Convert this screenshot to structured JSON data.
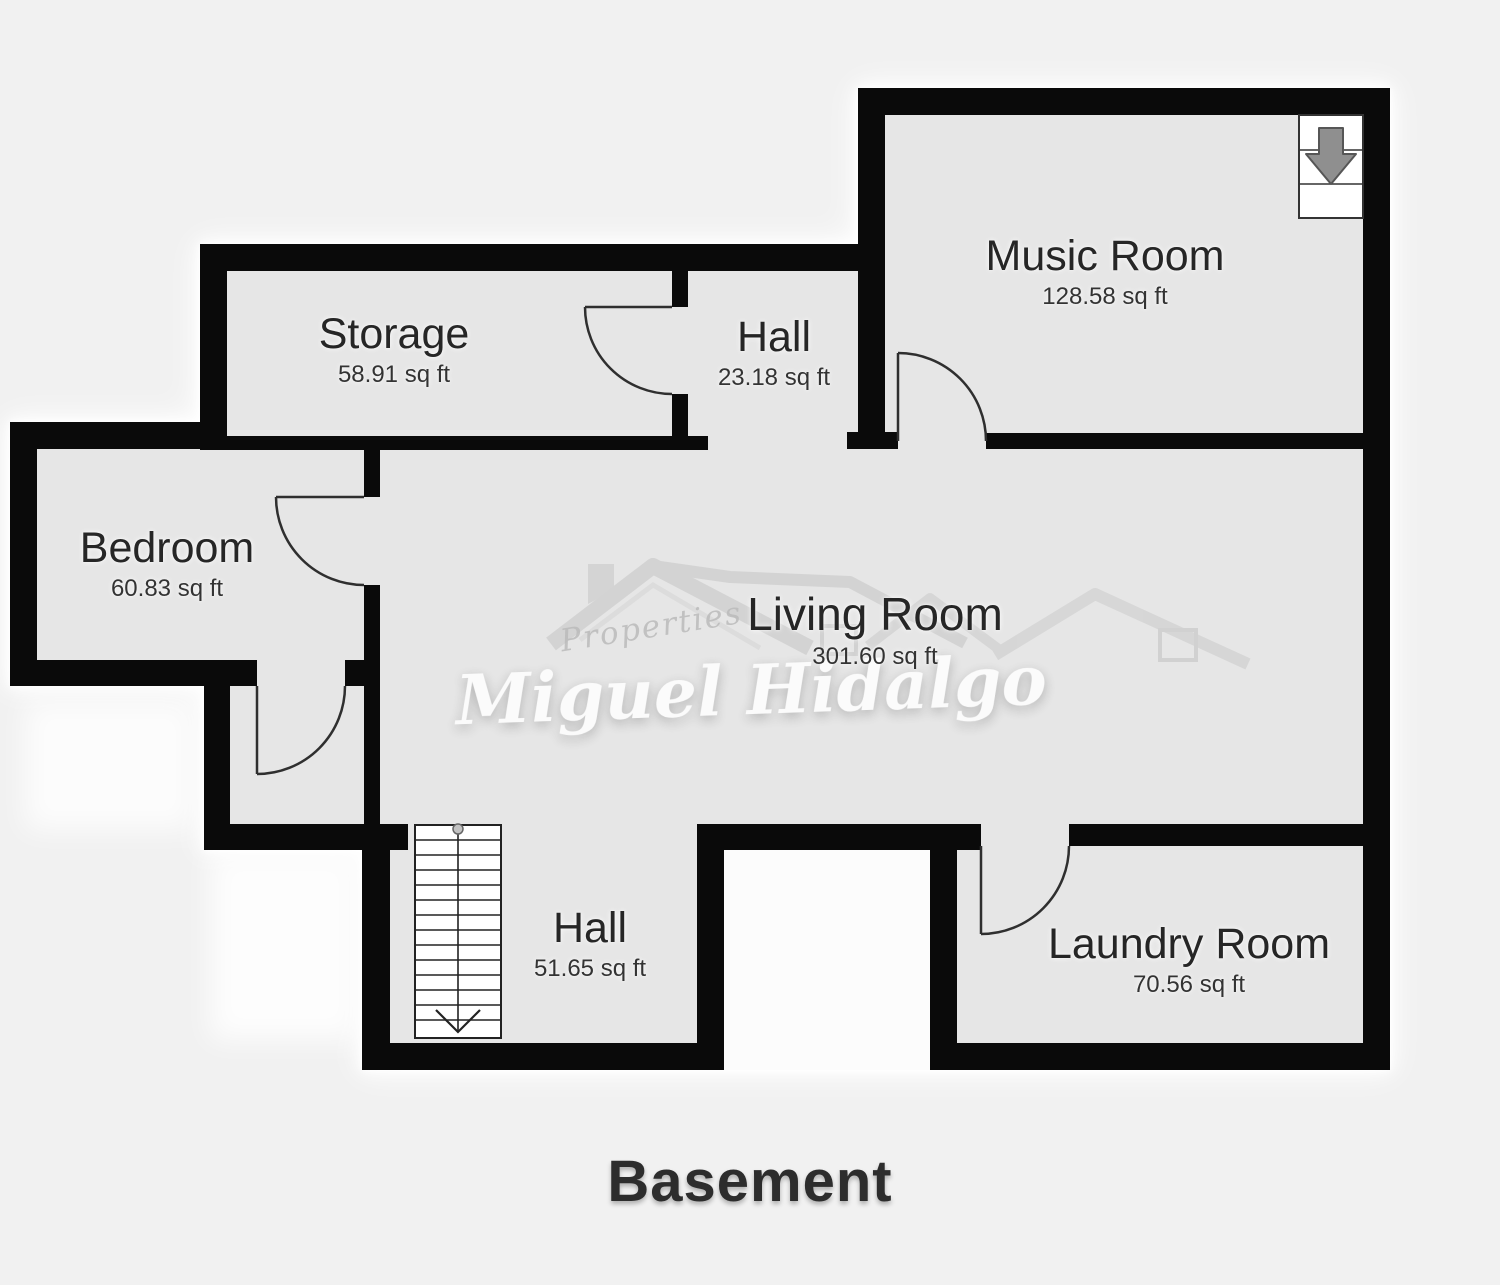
{
  "page": {
    "title": "Basement",
    "background": "#f1f1f1"
  },
  "watermark": {
    "brand_top": "Properties",
    "brand_name": "Miguel Hidalgo"
  },
  "rooms": [
    {
      "id": "music-room",
      "name": "Music Room",
      "area": "128.58 sq ft"
    },
    {
      "id": "storage",
      "name": "Storage",
      "area": "58.91 sq ft"
    },
    {
      "id": "hall-upper",
      "name": "Hall",
      "area": "23.18 sq ft"
    },
    {
      "id": "bedroom",
      "name": "Bedroom",
      "area": "60.83 sq ft"
    },
    {
      "id": "living-room",
      "name": "Living Room",
      "area": "301.60 sq ft"
    },
    {
      "id": "hall-lower",
      "name": "Hall",
      "area": "51.65 sq ft"
    },
    {
      "id": "laundry-room",
      "name": "Laundry Room",
      "area": "70.56 sq ft"
    }
  ],
  "colors": {
    "wall": "#0a0a0a",
    "floor": "#e6e6e6",
    "background": "#f1f1f1",
    "exterior_glow": "#ffffff",
    "stairs_arrow": "#8f8f8f"
  },
  "icons": {
    "music_room_corner": "stairs-down-arrow-icon",
    "lower_hall": "staircase-icon",
    "door_symbol": "door-swing-arc-icon"
  }
}
